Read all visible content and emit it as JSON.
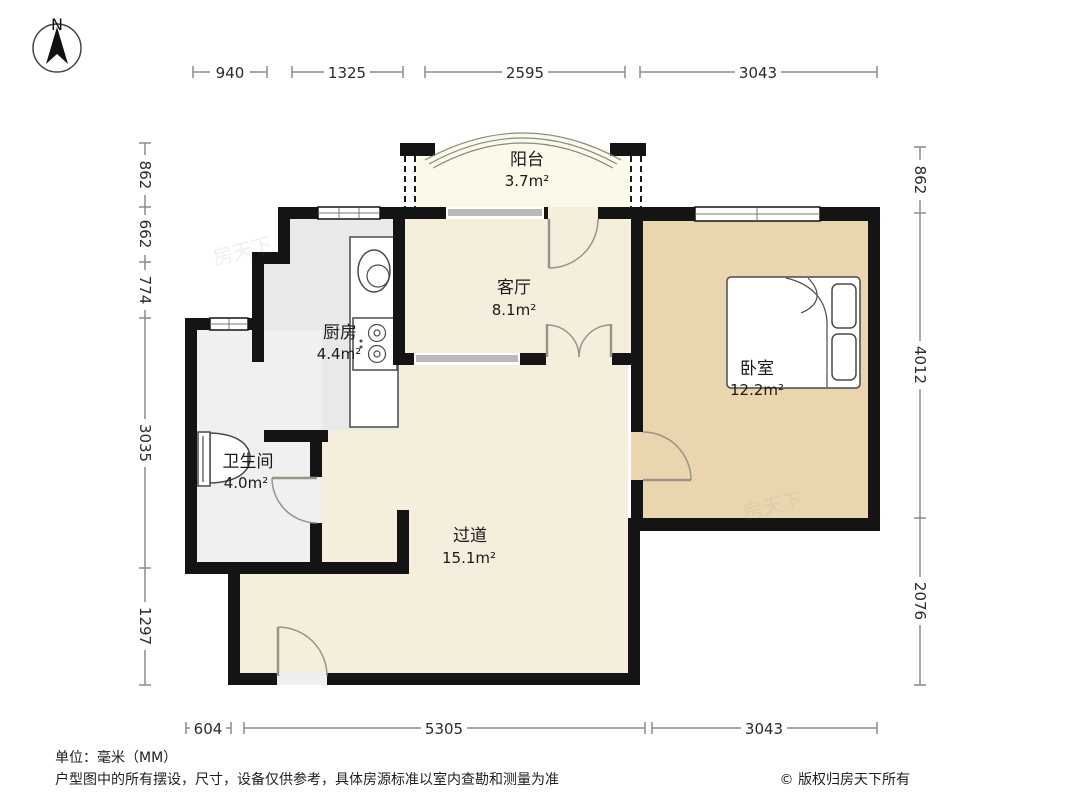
{
  "compass": {
    "north_label": "N"
  },
  "rooms": {
    "balcony": {
      "name": "阳台",
      "area": "3.7m²"
    },
    "living_room": {
      "name": "客厅",
      "area": "8.1m²"
    },
    "kitchen": {
      "name": "厨房",
      "area": "4.4m²"
    },
    "bathroom": {
      "name": "卫生间",
      "area": "4.0m²"
    },
    "hallway": {
      "name": "过道",
      "area": "15.1m²"
    },
    "bedroom": {
      "name": "卧室",
      "area": "12.2m²"
    }
  },
  "dimensions_mm": {
    "top": [
      "940",
      "1325",
      "2595",
      "3043"
    ],
    "left": [
      "862",
      "662",
      "774",
      "3035",
      "1297"
    ],
    "right": [
      "862",
      "4012",
      "2076"
    ],
    "bottom": [
      "604",
      "5305",
      "3043"
    ]
  },
  "footer": {
    "unit_note": "单位：毫米（MM）",
    "disclaimer": "户型图中的所有摆设，尺寸，设备仅供参考，具体房源标准以室内查勘和测量为准",
    "copyright": "© 版权归房天下所有"
  },
  "watermark": "房天下",
  "colors": {
    "wall": "#141414",
    "floor_main": "#f6eedc",
    "floor_bedroom": "#ead6ae",
    "floor_kitchen": "#e9e9e9",
    "floor_bathroom": "#f0f0f0",
    "floor_balcony": "#fbf9e7"
  }
}
